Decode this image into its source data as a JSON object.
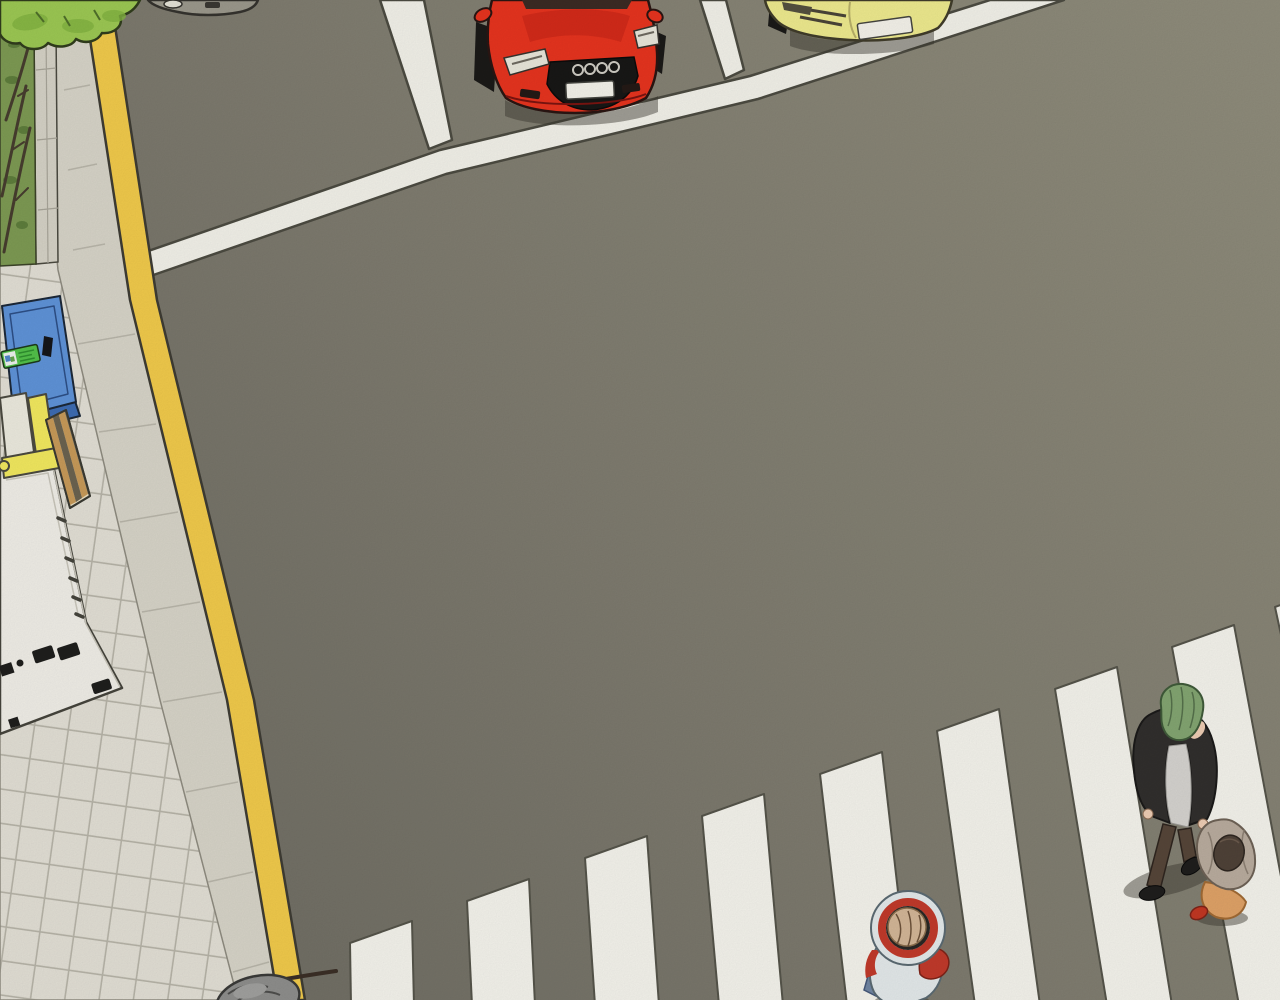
{
  "scene": {
    "setting": "aerial webtoon-style view of a street corner: parking lot at top, sidewalk with kiosk at left, zebra crosswalk at bottom right",
    "objects": [
      {
        "name": "red-car",
        "desc": "red car parked nose-out in parking bay"
      },
      {
        "name": "yellow-car",
        "desc": "pale yellow car parked in next bay"
      },
      {
        "name": "gray-car",
        "desc": "gray car edge visible at top"
      },
      {
        "name": "parking-lines",
        "desc": "white boundary and separator lines"
      },
      {
        "name": "crosswalk",
        "desc": "nine white zebra stripes crossing the road"
      },
      {
        "name": "pedestrian-green-hair",
        "desc": "man with green hair, dark jacket, brown pants"
      },
      {
        "name": "pedestrian-child-hood",
        "desc": "child in pale hooded jacket with red trim"
      },
      {
        "name": "pedestrian-beige-coat",
        "desc": "person in beige padded coat with orange bag and red shoes"
      },
      {
        "name": "pedestrian-gray-hair",
        "desc": "gray-haired head with cane at bottom left"
      },
      {
        "name": "vending-machine",
        "desc": "blue vending machine with green label"
      },
      {
        "name": "kiosk",
        "desc": "white rooftop structure with black vents"
      },
      {
        "name": "hedge",
        "desc": "green hedge at top left corner"
      },
      {
        "name": "yellow-curb",
        "desc": "yellow curb line along sidewalk"
      }
    ]
  },
  "colors": {
    "road_dark": "#6b6960",
    "road_mid": "#7d7a6e",
    "road_light": "#908d7c",
    "line_white": "#f2f1e9",
    "stripe_white": "#f4f3ec",
    "yellow_curb": "#f1ca4b",
    "curb_concrete": "#d7d4c8",
    "curb_mid": "#c3c0b3",
    "tile": "#e2dfd5",
    "tile_line": "#b7b4a8",
    "hedge_green": "#9cc853",
    "hedge_dark": "#83b441",
    "planter_green": "#7d9a53",
    "branch_brown": "#473d2f",
    "wall_gray": "#d5d2c6",
    "machine_blue": "#5f93d8",
    "machine_blue_dark": "#3d6cb2",
    "label_green": "#53c14a",
    "label_white": "#eef2ee",
    "kiosk_white": "#f0eee7",
    "vent_black": "#1f1f1d",
    "awning_tan": "#c79a59",
    "awning_dark": "#6b6350",
    "stand_yellow": "#f2e95f",
    "panel_white": "#eceade",
    "car_red": "#e6341f",
    "car_red_dark": "#c22315",
    "tire_black": "#1b1a18",
    "plate_white": "#f4f2ea",
    "car_yellow": "#eeea8e",
    "car_gray": "#9b988c",
    "shadow": "rgba(58,55,47,0.45)",
    "hair_green": "#83a571",
    "jacket_dark": "#312f2d",
    "shirt_gray": "#d5d3cf",
    "pants_brown": "#564639",
    "skin": "#eecdb4",
    "shoe_black": "#1f1e1d",
    "hood_pale": "#e3e9ea",
    "hood_interior": "#2a2724",
    "trim_red": "#c13a2b",
    "hair_tan": "#d3b697",
    "jeans_blue": "#7186a3",
    "kid_shoe": "#55585e",
    "coat_beige": "#b9ac9e",
    "head_brown": "#4f4238",
    "bag_orange": "#dfa267",
    "shoe_red": "#c23723",
    "gray_hair": "#8e8e8c",
    "cane_brown": "#3b2f26"
  }
}
